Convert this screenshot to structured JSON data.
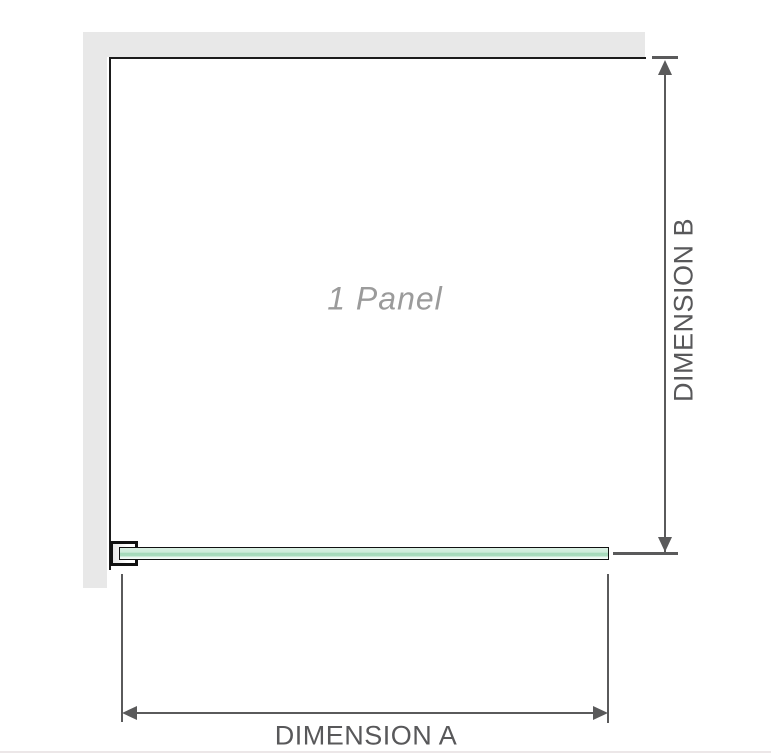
{
  "diagram": {
    "panel_label": "1 Panel",
    "dimension_a_label": "DIMENSION A",
    "dimension_b_label": "DIMENSION B"
  },
  "colors": {
    "wall": "#e8e8e8",
    "panel_outline": "#1b1b1b",
    "dimension_lines": "#5a5a5b",
    "dimension_text": "#58585a",
    "panel_label_text": "#9b9b9b",
    "glass_fill_light": "#d9f0e3",
    "glass_fill_dark": "#a5d9ba",
    "glass_border": "#111111",
    "footer_divider": "#ece7e8"
  }
}
